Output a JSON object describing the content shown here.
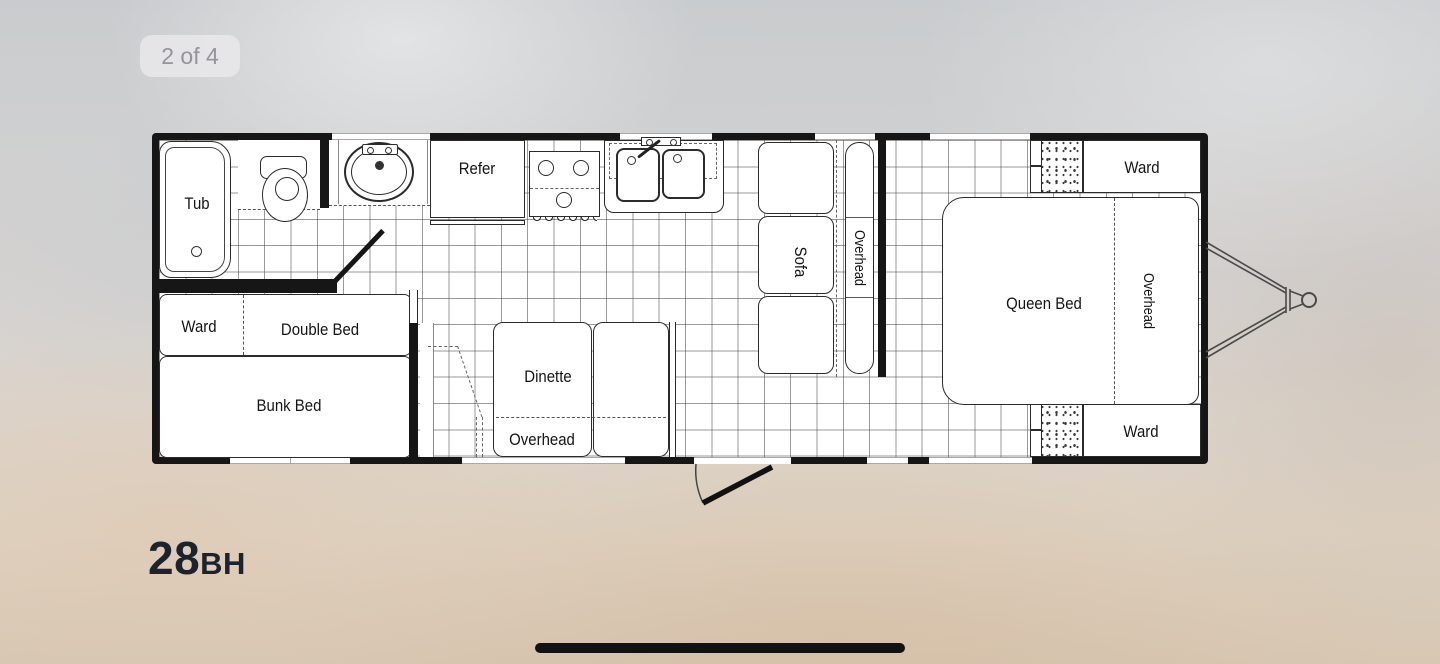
{
  "viewer": {
    "counter": "2 of 4"
  },
  "model": {
    "number": "28",
    "trim": "BH"
  },
  "floorplan": {
    "labels": {
      "tub": "Tub",
      "refer": "Refer",
      "sofa": "Sofa",
      "sofa_overhead": "Overhead",
      "queen_bed": "Queen Bed",
      "bed_overhead": "Overhead",
      "ward_front_top": "Ward",
      "ward_front_bottom": "Ward",
      "ward_bunk": "Ward",
      "double_bed": "Double Bed",
      "bunk_bed": "Bunk Bed",
      "dinette": "Dinette",
      "dinette_overhead": "Overhead"
    }
  },
  "colors": {
    "wall": "#161616",
    "line": "#2b2b2b",
    "grid": "#8f8f8f",
    "model_text": "#1c232e",
    "badge_bg": "#e9e8ea",
    "badge_text": "#94949b",
    "home_bar": "#121212"
  }
}
